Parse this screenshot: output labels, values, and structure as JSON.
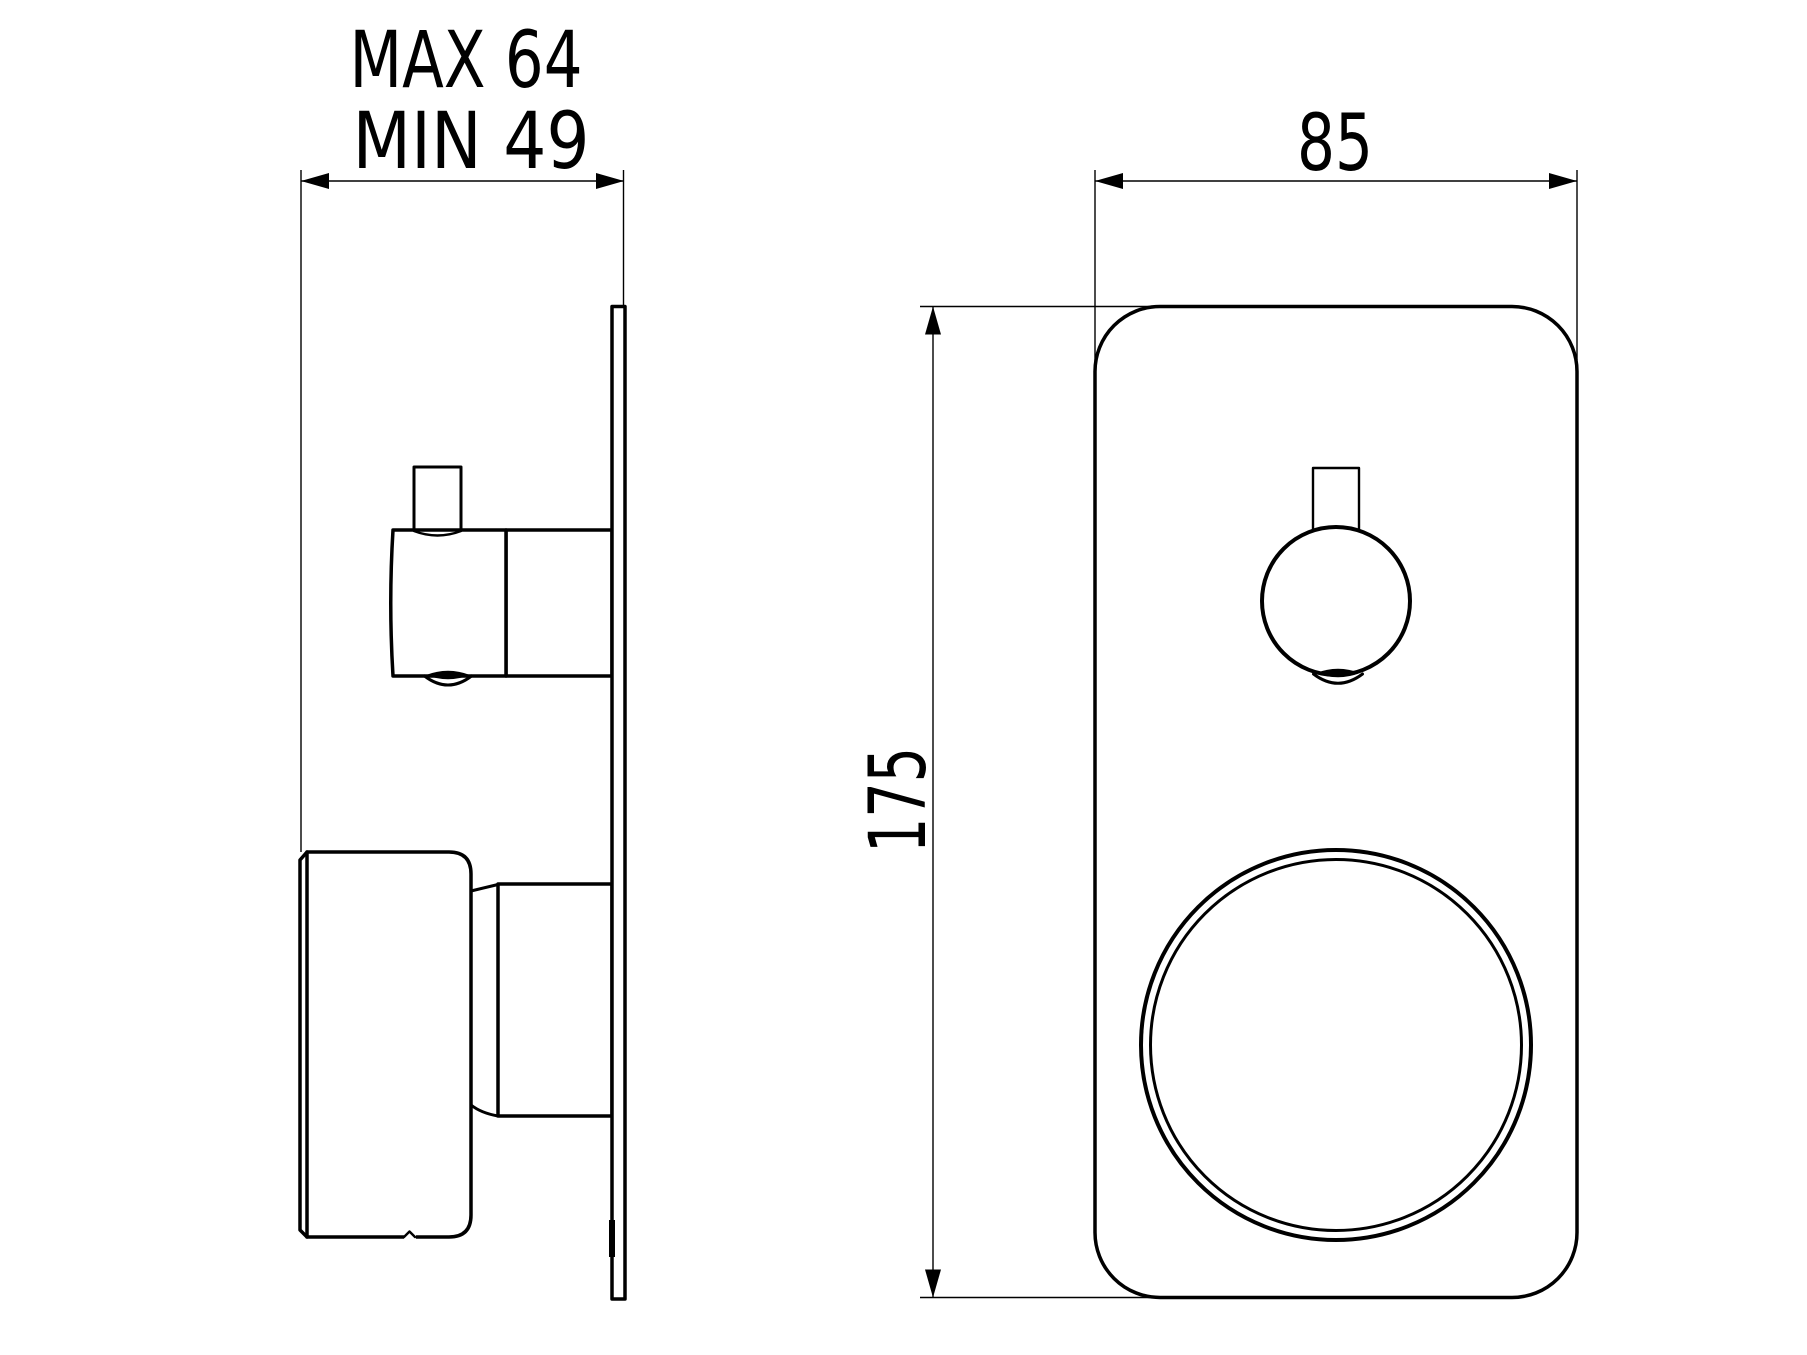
{
  "drawing": {
    "type": "technical-dimension-drawing",
    "views": {
      "side_view": "mixer valve side profile with wall plate",
      "front_view": "mixer valve front plate with lever handle and round knob"
    }
  },
  "dimensions": {
    "depth": {
      "line1": "MAX 64",
      "line2": "MIN 49"
    },
    "width": {
      "value": "85"
    },
    "height": {
      "value": "175"
    }
  },
  "colors": {
    "ink": "#000000",
    "background": "#ffffff"
  }
}
